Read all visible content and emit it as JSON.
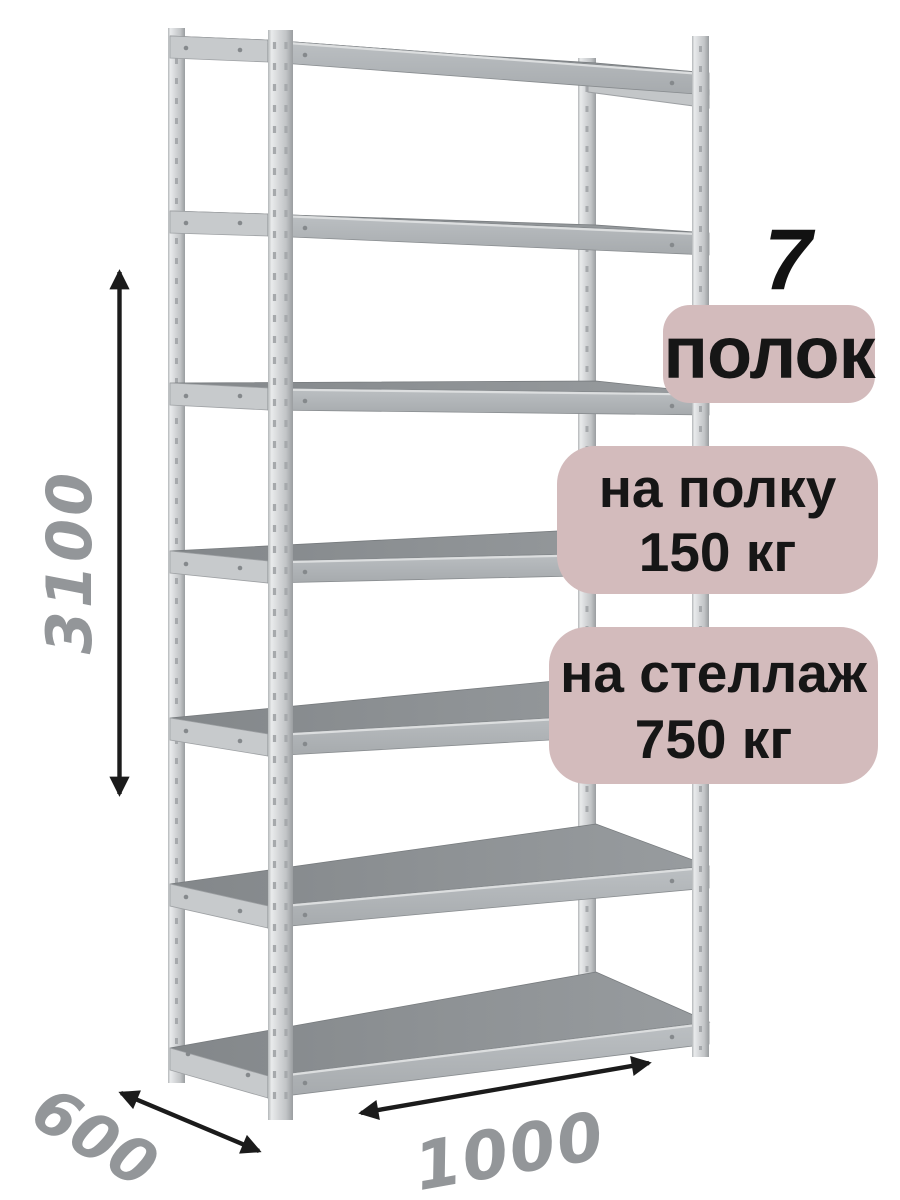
{
  "annotations": {
    "shelf_count_number": "7",
    "shelf_count_label": "полок",
    "per_shelf_line1": "на полку",
    "per_shelf_line2": "150 кг",
    "per_rack_line1": "на стеллаж",
    "per_rack_line2": "750 кг"
  },
  "dimensions": {
    "height": "3100",
    "width": "1000",
    "depth": "600"
  },
  "rack": {
    "shelves": 7,
    "posts": 4
  },
  "colors": {
    "badge-bg": "#d3bbbc",
    "badge-text": "#161616",
    "big-number": "#121212",
    "dim-text": "#939699",
    "arrow": "#1b1b1b",
    "bg": "#ffffff"
  }
}
